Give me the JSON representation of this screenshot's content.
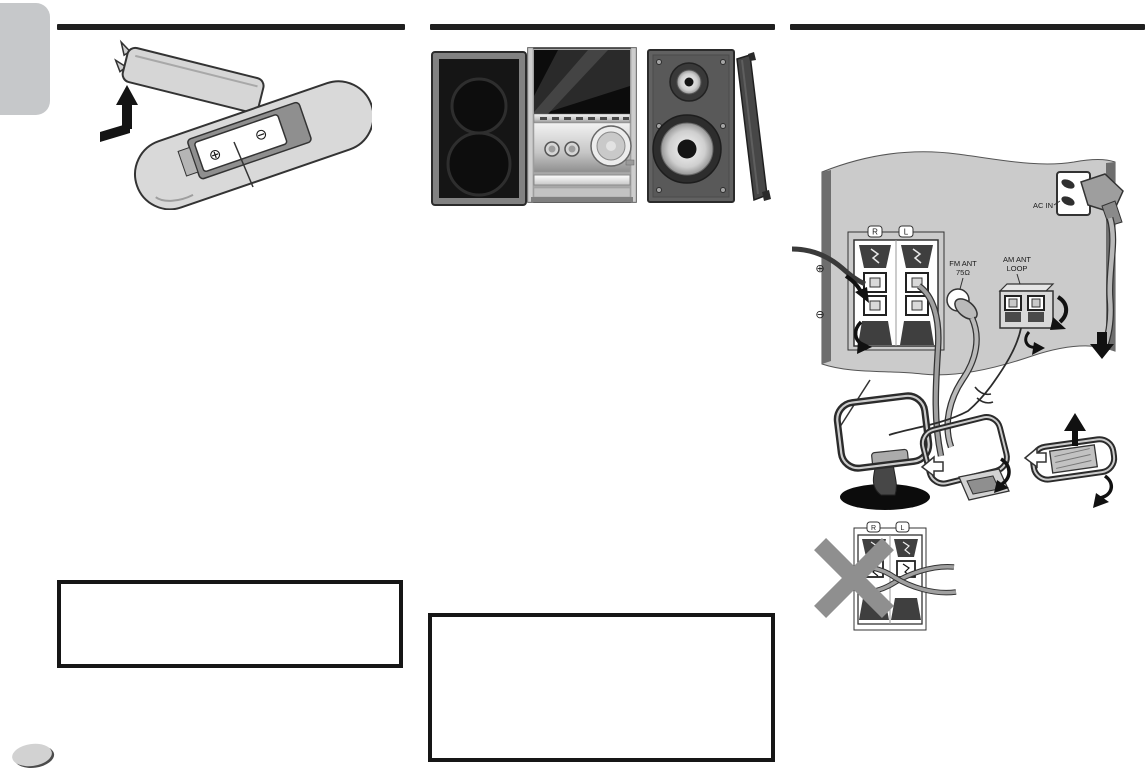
{
  "page": {
    "colors": {
      "panel_gray": "#cbcbcb",
      "section_rule": "#1f1f1f",
      "warning_x": "#8f8f8f"
    }
  },
  "remote_illustration": {
    "battery_plus_symbol": "⊕",
    "battery_minus_symbol": "⊖"
  },
  "rear_panel_diagram": {
    "speaker_terminals": {
      "right_channel_label": "R",
      "left_channel_label": "L",
      "plus_symbol": "⊕",
      "minus_symbol": "⊖"
    },
    "fm_antenna": {
      "label_line1": "FM ANT",
      "label_line2": "75Ω"
    },
    "am_antenna": {
      "label_line1": "AM ANT",
      "label_line2": "LOOP"
    },
    "ac_inlet": {
      "label": "AC IN"
    }
  },
  "incorrect_connection_warning": {
    "right_channel_label": "R",
    "left_channel_label": "L"
  }
}
